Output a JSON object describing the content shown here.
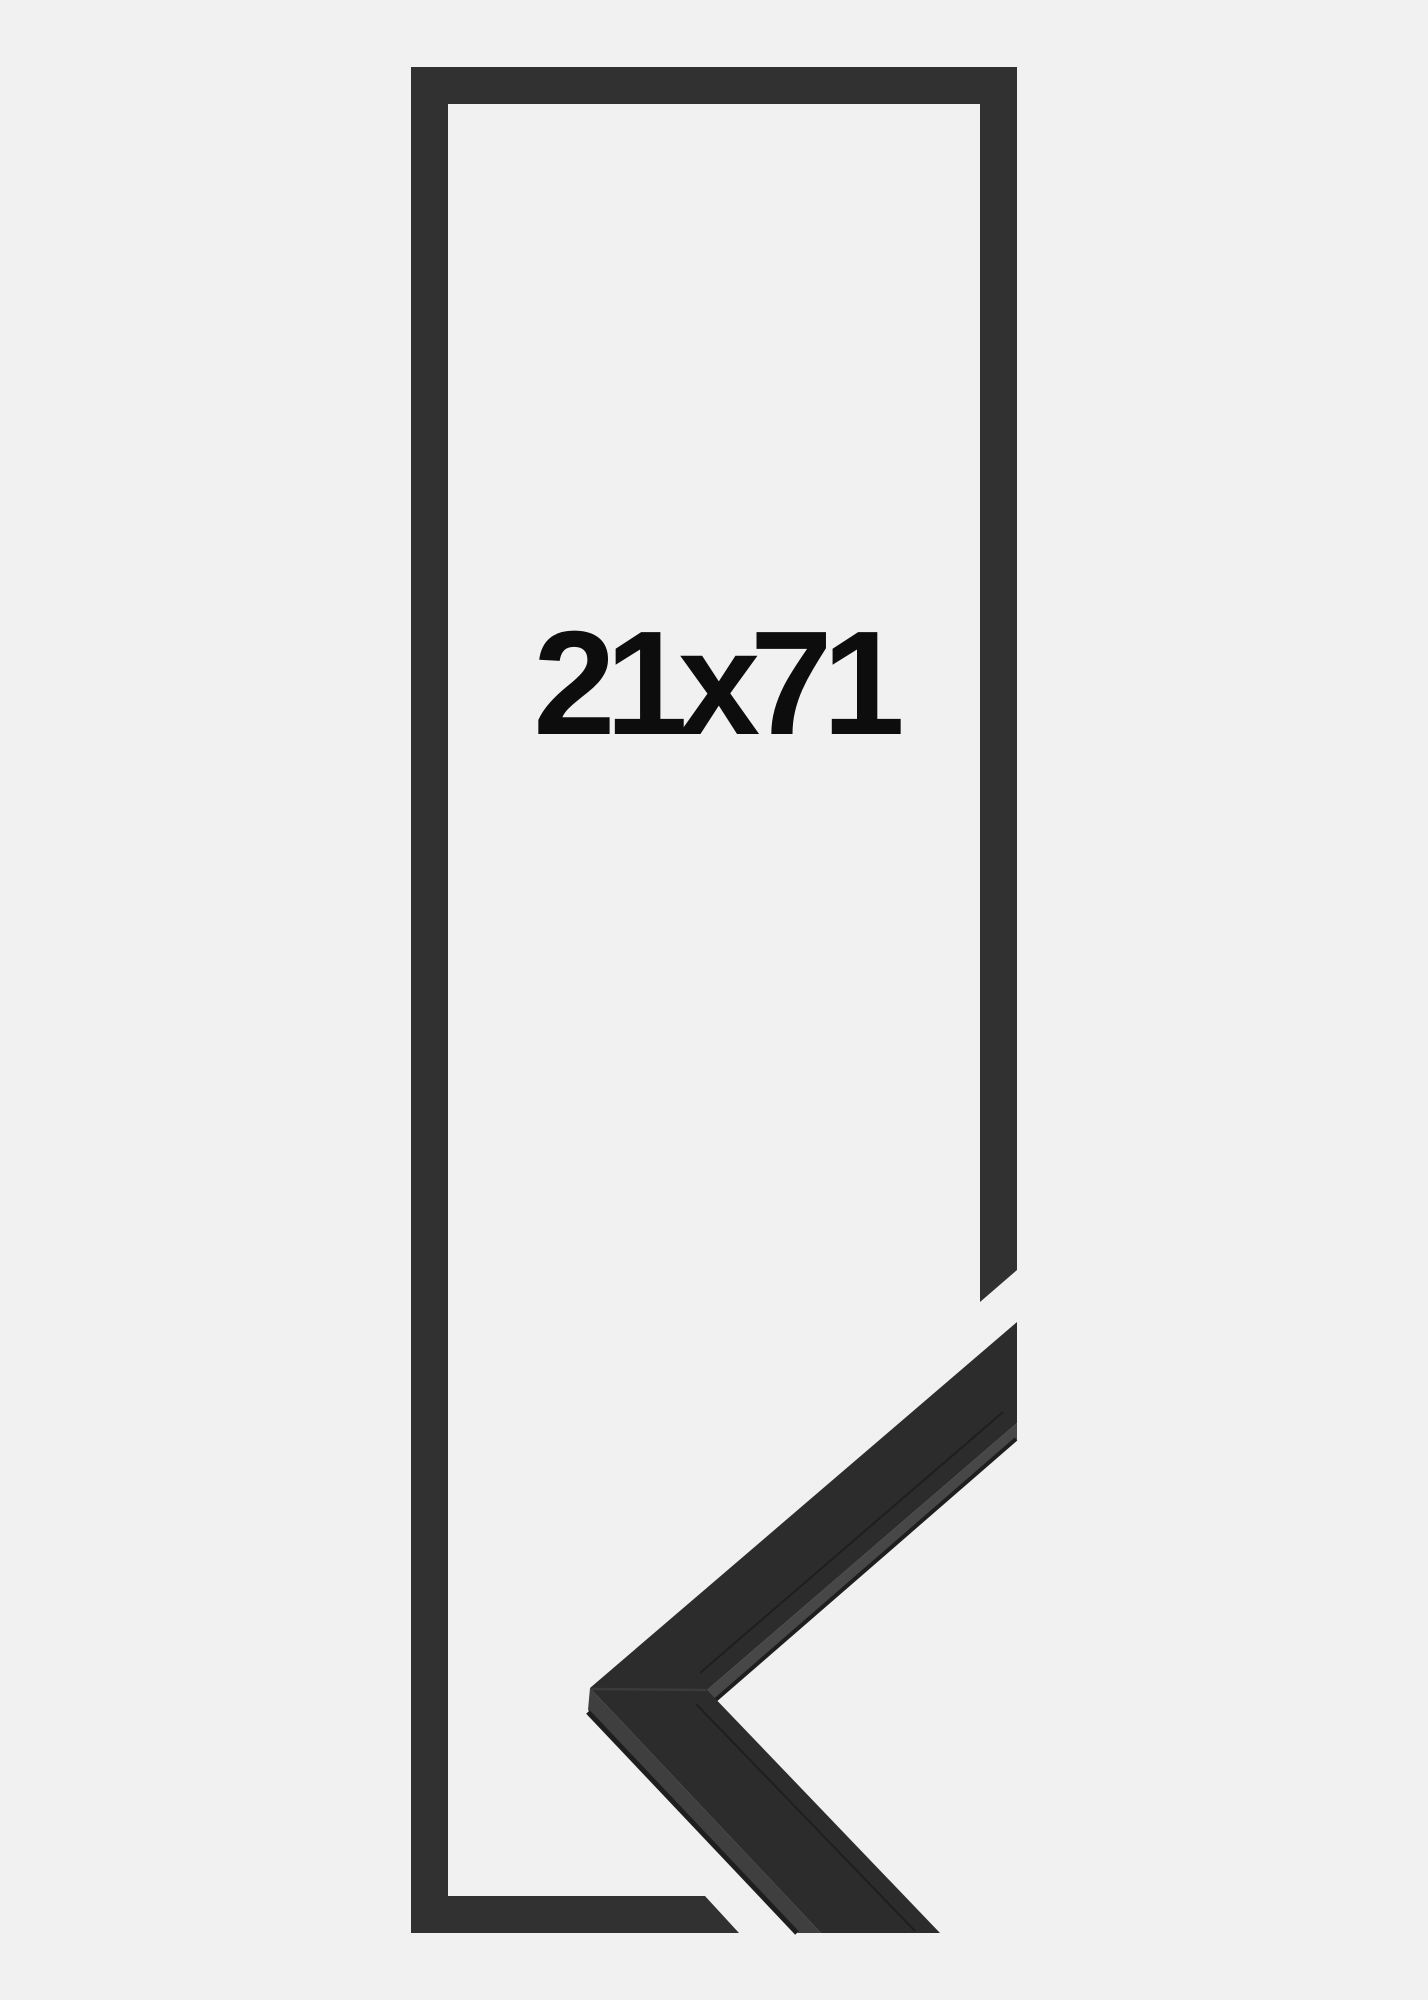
{
  "size_label": "21x71",
  "colors": {
    "background": "#f1f1f2",
    "frame_outline": "#313131",
    "moulding_face": "#2c2c2c",
    "moulding_side": "#3f3f3f",
    "moulding_side_inner": "#474747",
    "edge_shadow": "#1e1e1e",
    "miter_seam": "#3e3e3e",
    "label_text": "#0d0d0d"
  }
}
